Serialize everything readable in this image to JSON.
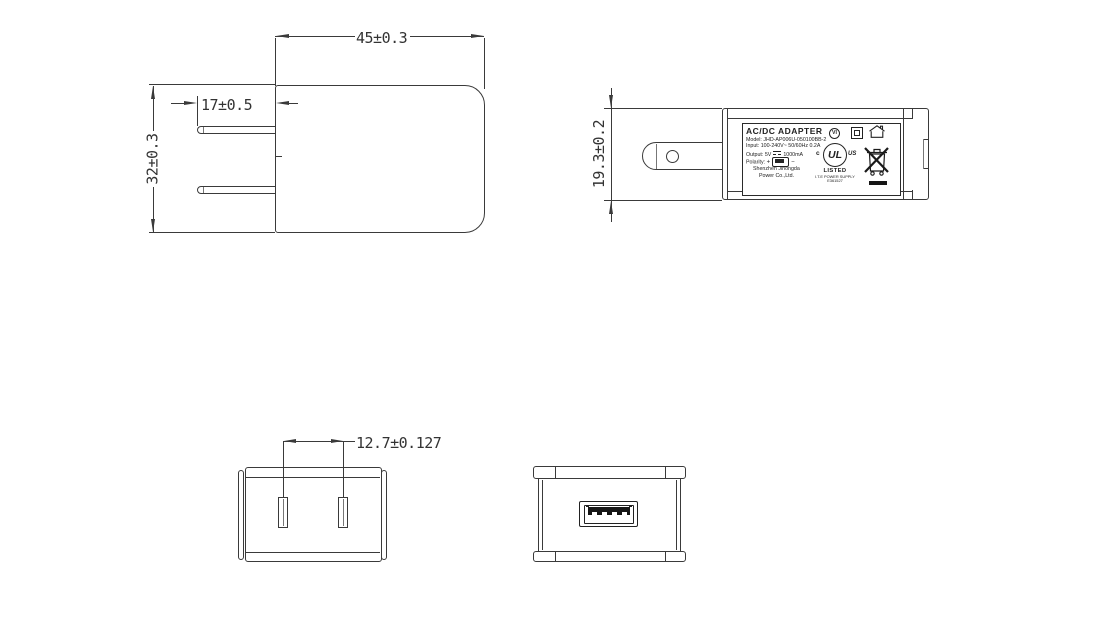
{
  "drawing": {
    "front_view": {
      "dim_width": "45±0.3",
      "dim_prong": "17±0.5",
      "dim_height": "32±0.3"
    },
    "side_view": {
      "dim_thickness": "19.3±0.2",
      "label": {
        "title": "AC/DC  ADAPTER",
        "model": "Model: JHD-AP006U-050100BB-2",
        "input": "Input: 100-240V~  50/60Hz  0.2A",
        "output_prefix": "Output: 5V",
        "output_suffix": "1000mA",
        "polarity_label": "Polarity:",
        "polarity_plus": "+",
        "polarity_minus": "−",
        "company_line1": "Shenzhen Jihongda",
        "company_line2": "Power Co.,Ltd.",
        "efficiency_mark": "VI",
        "ul_c": "c",
        "ul_letters": "UL",
        "ul_us": "US",
        "ul_listed": "LISTED",
        "ul_type": "I.T.E POWER SUPPLY",
        "ul_file": "E361527"
      }
    },
    "bottom_view": {
      "dim_pitch": "12.7±0.127"
    }
  },
  "icons": {
    "efficiency": "vi-level-circle-icon",
    "class_ii": "class-ii-double-square-icon",
    "indoor_use": "house-icon",
    "safety": "ul-listed-icon",
    "weee": "weee-crossed-bin-icon",
    "polarity": "usb-connector-icon",
    "dc": "dc-voltage-symbol-icon",
    "usb_port": "usb-a-port"
  },
  "colors": {
    "line": "#3a3a3a",
    "label_line": "#222222",
    "fill_black": "#151515",
    "background": "#ffffff"
  }
}
